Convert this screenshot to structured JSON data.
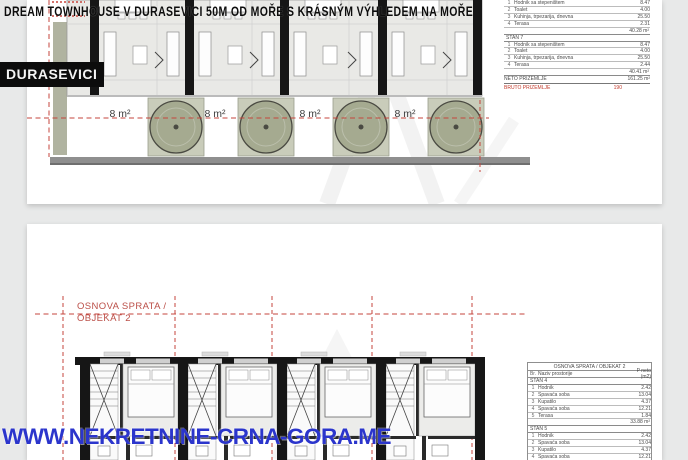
{
  "overlay": {
    "top_caption": "DREAM TOWNHOUSE V DURASEVICI 50M OD MOŘE S KRÁSNÝM VÝHLEDEM NA MOŘE",
    "location_label": "DURASEVICI",
    "website": "WWW.NEKRETNINE-CRNA-GORA.ME"
  },
  "colors": {
    "website_blue": "#2b35cc",
    "plan_red": "#c5453c",
    "tree_green": "#a5aa90",
    "terrace_green": "#c9ccba",
    "wall_black": "#161616",
    "table_total_red": "#c0392b"
  },
  "ground_floor_plan": {
    "terrace_labels": [
      "8 m²",
      "8 m²",
      "8 m²",
      "8 m²"
    ]
  },
  "ground_floor_table": {
    "partial_unit": {
      "rows": [
        {
          "n": "1",
          "name": "Hodnik sa stepeništem",
          "val": "8.47"
        },
        {
          "n": "2",
          "name": "Toalet",
          "val": "4.00"
        },
        {
          "n": "3",
          "name": "Kuhinja, trpezarija, dnevna",
          "val": "25.50"
        },
        {
          "n": "4",
          "name": "Terasa",
          "val": "2.31"
        }
      ],
      "subtotal": "40.28 m²"
    },
    "stan7": {
      "label": "STAN 7",
      "rows": [
        {
          "n": "1",
          "name": "Hodnik sa stepeništem",
          "val": "8.47"
        },
        {
          "n": "2",
          "name": "Toalet",
          "val": "4.00"
        },
        {
          "n": "3",
          "name": "Kuhinja, trpezarija, dnevna",
          "val": "25.50"
        },
        {
          "n": "4",
          "name": "Terasa",
          "val": "2.44"
        }
      ],
      "subtotal": "40.41 m²"
    },
    "neto": {
      "label": "NETO PRIZEMLJE",
      "value": "161.25 m²"
    },
    "bruto": {
      "label": "BRUTO PRIZEMLJE",
      "value": "190"
    }
  },
  "first_floor_plan": {
    "title_line1": "OSNOVA SPRATA /",
    "title_line2": "OBJEKAT 2"
  },
  "first_floor_table": {
    "title": "OSNOVA SPRATA / OBJEKAT 2",
    "headers": {
      "num": "Br.",
      "name": "Naziv prostorije",
      "area": "P neto (m2)"
    },
    "stan4": {
      "label": "STAN 4",
      "rows": [
        {
          "n": "1",
          "name": "Hodnik",
          "val": "2.42"
        },
        {
          "n": "2",
          "name": "Spavaća soba",
          "val": "13.04"
        },
        {
          "n": "3",
          "name": "Kupatilo",
          "val": "4.37"
        },
        {
          "n": "4",
          "name": "Spavaća soba",
          "val": "12.21"
        },
        {
          "n": "5",
          "name": "Terasa",
          "val": "1.84"
        }
      ],
      "subtotal": "33.88 m²"
    },
    "stan5": {
      "label": "STAN 5",
      "rows": [
        {
          "n": "1",
          "name": "Hodnik",
          "val": "2.42"
        },
        {
          "n": "2",
          "name": "Spavaća soba",
          "val": "13.04"
        },
        {
          "n": "3",
          "name": "Kupatilo",
          "val": "4.37"
        },
        {
          "n": "4",
          "name": "Spavaća soba",
          "val": "12.21"
        },
        {
          "n": "5",
          "name": "Terasa",
          "val": "1.88"
        }
      ]
    }
  }
}
